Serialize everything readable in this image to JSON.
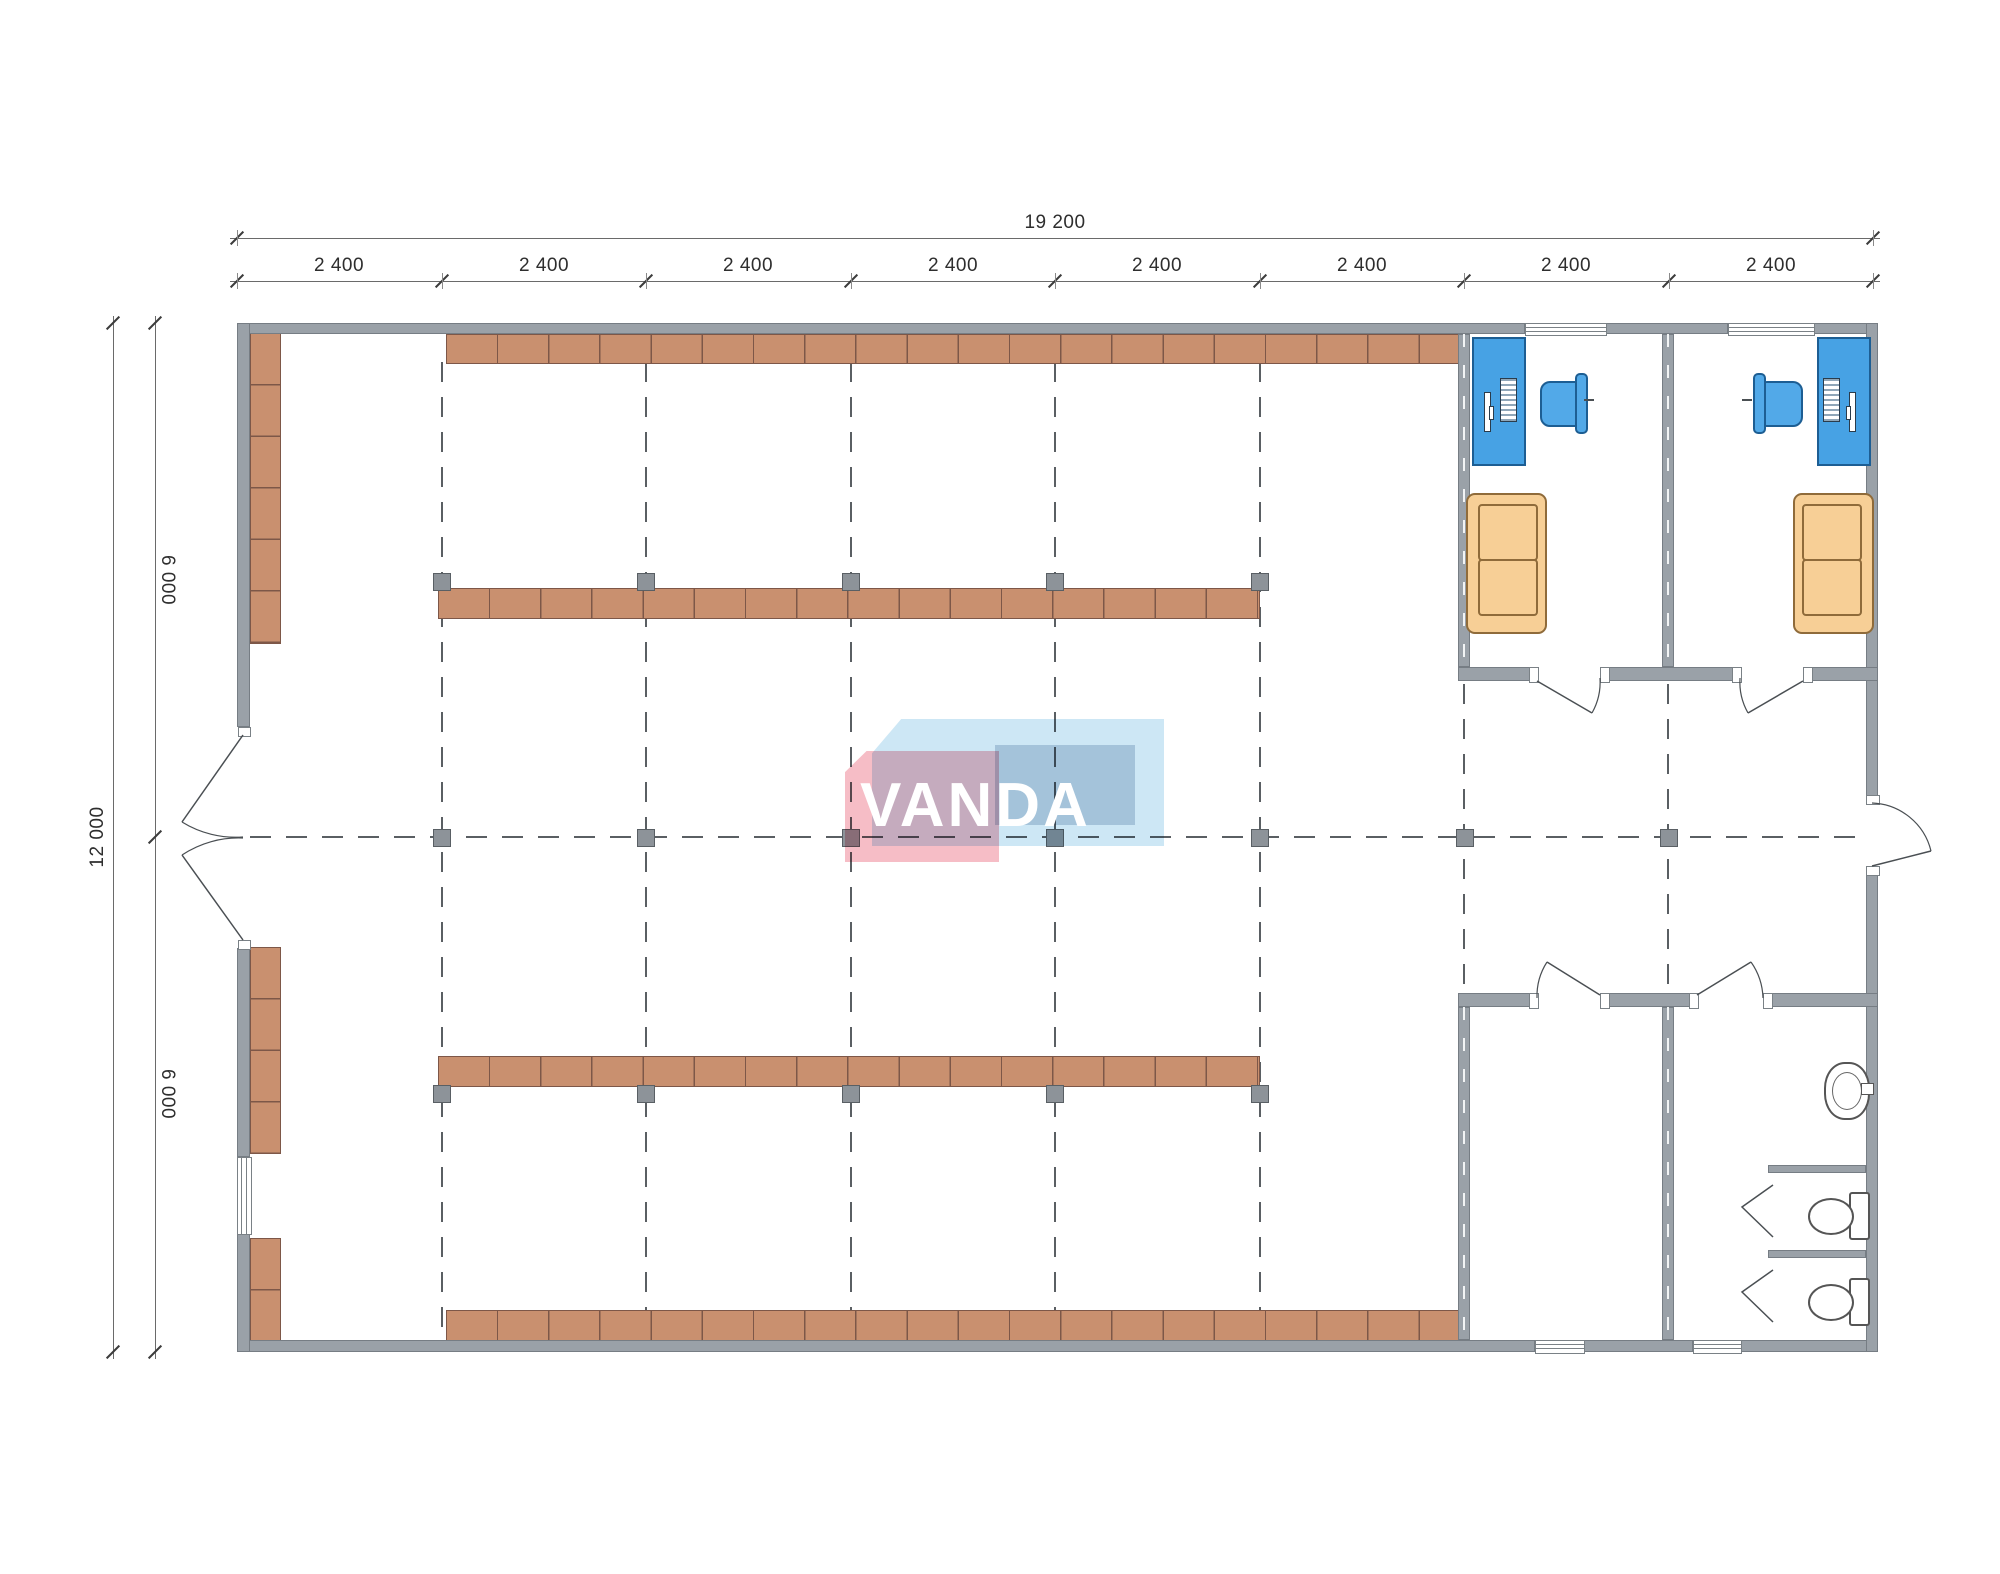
{
  "plan": {
    "kind": "retail-store-floor-plan"
  },
  "dimensions": {
    "total_width": "19 200",
    "bays": [
      "2 400",
      "2 400",
      "2 400",
      "2 400",
      "2 400",
      "2 400",
      "2 400",
      "2 400"
    ],
    "total_height": "12 000",
    "height_segments": [
      "6 000",
      "6 000"
    ]
  },
  "logo": {
    "text": "VANDA"
  },
  "colors": {
    "wall": "#9aa1a8",
    "shelf": "#c9906f",
    "shelf_divider": "#7d5748",
    "desk": "#47a2e4",
    "chair": "#52a9e8",
    "sofa": "#f7cf96",
    "column_marker": "#8d9399",
    "grid_line": "#5a5f63",
    "logo_pink": "#f6bdc6",
    "logo_blue": "#cde7f5",
    "logo_slate": "#ccd7e3"
  }
}
